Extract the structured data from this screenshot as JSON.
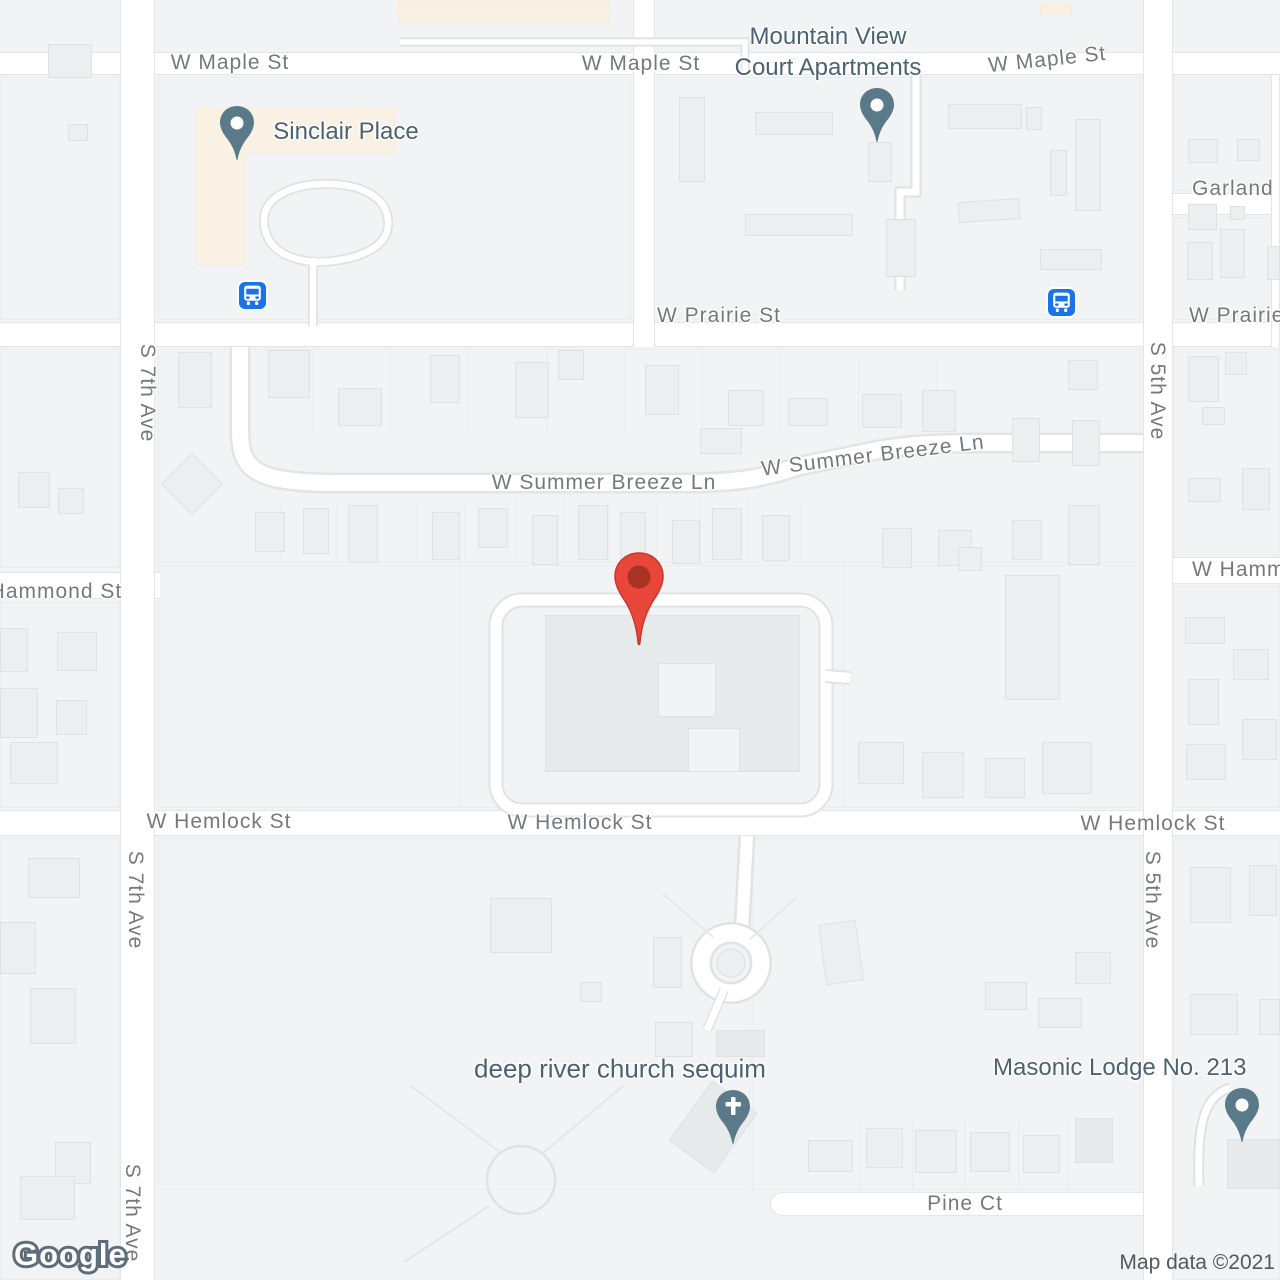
{
  "attribution": {
    "logo": "Google",
    "map_data": "Map data ©2021"
  },
  "streets": {
    "maple": "W Maple St",
    "prairie": "W Prairie St",
    "summer_breeze": "W Summer Breeze Ln",
    "hammond": "W Hammond St",
    "hemlock": "W Hemlock St",
    "pine": "Pine Ct",
    "garland": "Garland Pl",
    "s7th": "S 7th Ave",
    "s5th": "S 5th Ave"
  },
  "pois": {
    "sinclair": {
      "name": "Sinclair Place",
      "icon": "place-pin"
    },
    "mountain_view": {
      "name": "Mountain View Court Apartments",
      "line1": "Mountain View",
      "line2": "Court Apartments",
      "icon": "place-pin"
    },
    "church": {
      "name": "deep river church sequim",
      "icon": "church-cross-pin"
    },
    "masonic": {
      "name": "Masonic Lodge No. 213",
      "icon": "place-pin"
    }
  },
  "markers": {
    "selected_location": {
      "icon": "red-location-pin"
    },
    "bus_stops": {
      "icon": "bus-stop",
      "count": 2
    }
  },
  "colors": {
    "land": "#F1F3F5",
    "road": "#FFFFFF",
    "building": "#ECEEF0",
    "poi_area": "#FAF1E5",
    "marker_red": "#E8463B",
    "poi_pin": "#5B7A89",
    "bus_blue": "#1A73E8",
    "poi_label": "#4C6270",
    "street_label": "#75797E"
  }
}
